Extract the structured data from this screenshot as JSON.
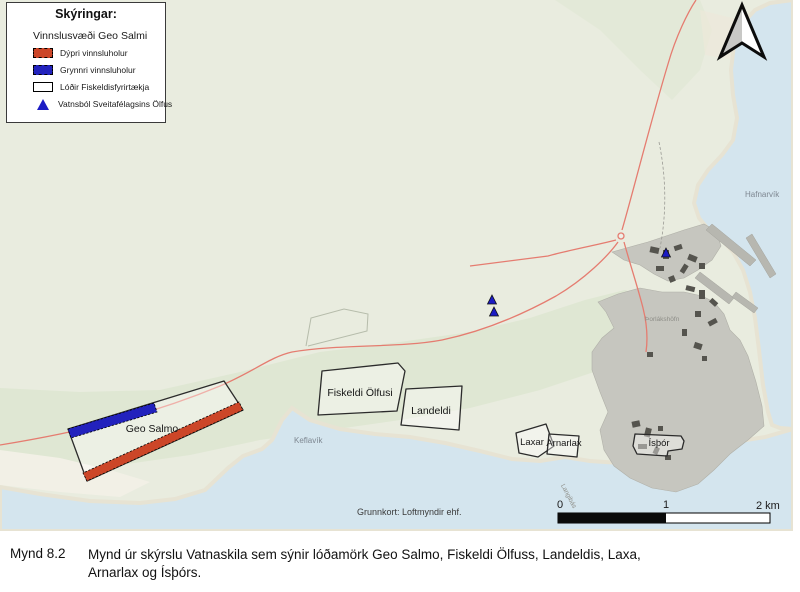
{
  "figure_caption": {
    "label": "Mynd 8.2",
    "line1": "Mynd úr skýrslu Vatnaskila sem sýnir lóðamörk Geo Salmo, Fiskeldi Ölfuss, Landeldis, Laxa,",
    "line2": "Arnarlax og Ísþórs."
  },
  "legend": {
    "title": "Skýringar:",
    "subtitle": "Vinnslusvæði Geo Salmi",
    "items": [
      {
        "label": "Dýpri vinnsluholur",
        "swatch_color": "#cc4628",
        "swatch_type": "filled-dashed"
      },
      {
        "label": "Grynnri vinnsluholur",
        "swatch_color": "#2222bd",
        "swatch_type": "filled-dashed"
      },
      {
        "label": "Lóðir Fiskeldisfyrirtækja",
        "swatch_color": "#ffffff",
        "swatch_type": "outline"
      },
      {
        "label": "Vatnsból Sveitafélagsins Ölfus",
        "swatch_color": "#1c1cc4",
        "swatch_type": "triangle"
      }
    ]
  },
  "map": {
    "plots": {
      "geo_salmo": "Geo Salmo",
      "fiskeldi_olfusi": "Fiskeldi Ölfusi",
      "landeldi": "Landeldi",
      "laxar": "Laxar",
      "arnarlax": "Arnarlax",
      "isthor": "Ísþór"
    },
    "places": {
      "keflavik": "Keflavík",
      "hafnarvik": "Hafnarvík",
      "thorlakshofn": "Þorlákshöfn",
      "langibas": "Langibás"
    },
    "attribution": "Grunnkort: Loftmyndir ehf.",
    "scalebar": {
      "t0": "0",
      "t1": "1",
      "t2": "2 km"
    },
    "colors": {
      "water": "#d4e5ee",
      "land": "#e9ecdf",
      "coastal_green": "#dce6cf",
      "town": "#c6c6bf",
      "road": "#e57c70",
      "deep_wells": "#cc4628",
      "shallow_wells": "#2222bd",
      "water_source_marker": "#1c1cc4"
    }
  }
}
